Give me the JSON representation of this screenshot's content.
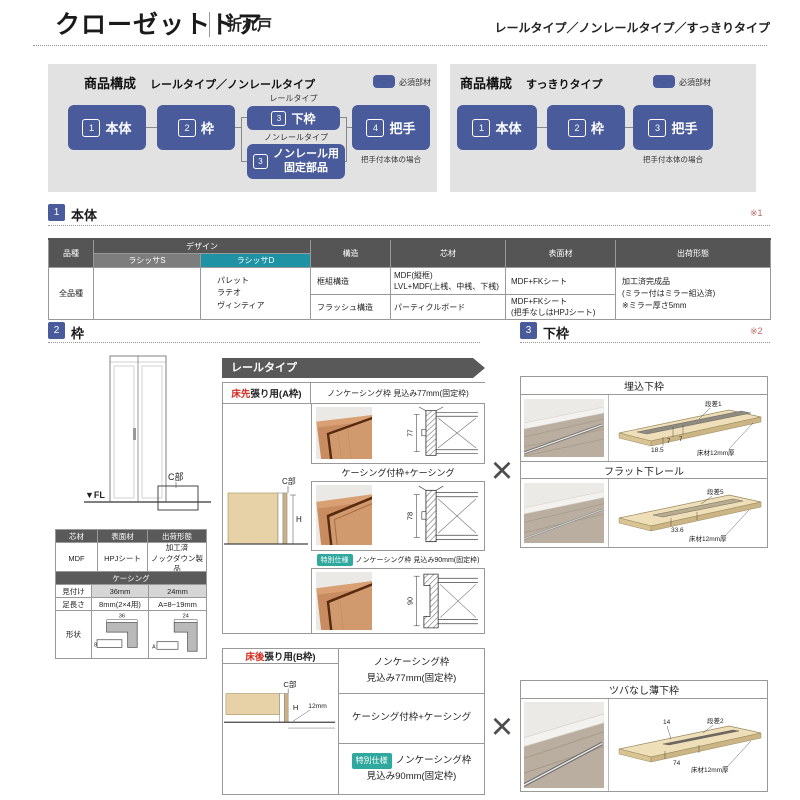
{
  "header": {
    "title": "クローゼットドア",
    "subtitle": "折れ戸",
    "types": "レールタイプ／ノンレールタイプ／すっきりタイプ"
  },
  "colors": {
    "accent_blue": "#4a5b9c",
    "lasissa_d_teal": "#1f93a3",
    "special_badge_teal": "#2fa89e",
    "floor_red": "#d42b1e",
    "panel_gray": "#e2e2e2",
    "table_header_dark": "#555555"
  },
  "flow_rail": {
    "title": "商品構成",
    "subtitle": "レールタイプ／ノンレールタイプ",
    "legend": "必須部材",
    "n1": "1",
    "b1": "本体",
    "n2": "2",
    "b2": "枠",
    "branch1": "レールタイプ",
    "n3a": "3",
    "b3a": "下枠",
    "branch2": "ノンレールタイプ",
    "n3b": "3",
    "b3b1": "ノンレール用",
    "b3b2": "固定部品",
    "n4": "4",
    "b4": "把手",
    "note": "把手付本体の場合"
  },
  "flow_simple": {
    "title": "商品構成",
    "subtitle": "すっきりタイプ",
    "legend": "必須部材",
    "n1": "1",
    "b1": "本体",
    "n2": "2",
    "b2": "枠",
    "n3": "3",
    "b3": "把手",
    "note": "把手付本体の場合"
  },
  "sections": {
    "n1": "1",
    "t1": "本体",
    "ref1": "※1",
    "n2": "2",
    "t2": "枠",
    "n3": "3",
    "t3": "下枠",
    "ref2": "※2"
  },
  "main_table": {
    "h_type": "品種",
    "h_design": "デザイン",
    "h_s": "ラシッサS",
    "h_d": "ラシッサD",
    "h_struct": "構造",
    "h_core": "芯材",
    "h_surface": "表面材",
    "h_ship": "出荷形態",
    "type_all": "全品種",
    "designs_d": [
      "パレット",
      "ラテオ",
      "ヴィンティア"
    ],
    "struct1": "框組構造",
    "struct2": "フラッシュ構造",
    "core1a": "MDF(縦框)",
    "core1b": "LVL+MDF(上桟、中桟、下桟)",
    "core2": "パーティクルボード",
    "surface1": "MDF+FKシート",
    "surface2a": "MDF+FKシート",
    "surface2b": "(把手なしはHPJシート)",
    "ship1": "加工済完成品",
    "ship2": "(ミラー付はミラー組込済)",
    "ship3": "※ミラー厚さ5mm"
  },
  "door_diagram": {
    "fl": "▼FL",
    "c_label": "C部"
  },
  "spec_table": {
    "h_core": "芯材",
    "h_surface": "表面材",
    "h_ship": "出荷形態",
    "core": "MDF",
    "surface": "HPJシート",
    "ship1": "加工済",
    "ship2": "ノックダウン製品"
  },
  "casing_table": {
    "title": "ケーシング",
    "r1_label": "見付け",
    "r1_v1": "36mm",
    "r1_v2": "24mm",
    "r2_label": "足長さ",
    "r2_v1": "8mm(2×4用)",
    "r2_v2": "A=8~19mm",
    "r3_label": "形状",
    "dim36": "36",
    "dim8": "8",
    "dim24": "24",
    "dimA": "A"
  },
  "rail_banner": "レールタイプ",
  "frame_a": {
    "floor_red": "床先",
    "header_rest": "張り用(A枠)",
    "c_label": "C部",
    "h_label": "H",
    "row1_title": "ノンケーシング枠 見込み77mm(固定枠)",
    "dim1": "77",
    "row2_title": "ケーシング付枠+ケーシング",
    "dim2": "78",
    "badge": "特別仕様",
    "row3_title": "ノンケーシング枠 見込み90mm(固定枠)",
    "dim3": "90"
  },
  "frame_b": {
    "floor_red": "床後",
    "header_rest": "張り用(B枠)",
    "c_label": "C部",
    "h_label": "H",
    "dim12": "12mm",
    "row1a": "ノンケーシング枠",
    "row1b": "見込み77mm(固定枠)",
    "row2": "ケーシング付枠+ケーシング",
    "badge": "特別仕様",
    "row3a": "ノンケーシング枠",
    "row3b": "見込み90mm(固定枠)"
  },
  "lower_frames": {
    "f1_title": "埋込下枠",
    "f1_step": "段差1",
    "f1_d7a": "7",
    "f1_d7b": "7",
    "f1_d185": "18.5",
    "f1_floor": "床材12mm厚",
    "f2_title": "フラット下レール",
    "f2_step": "段差5",
    "f2_d336": "33.6",
    "f2_floor": "床材12mm厚",
    "f3_title": "ツバなし薄下枠",
    "f3_d14": "14",
    "f3_step": "段差2",
    "f3_d74": "74",
    "f3_floor": "床材12mm厚"
  },
  "cross": "×"
}
